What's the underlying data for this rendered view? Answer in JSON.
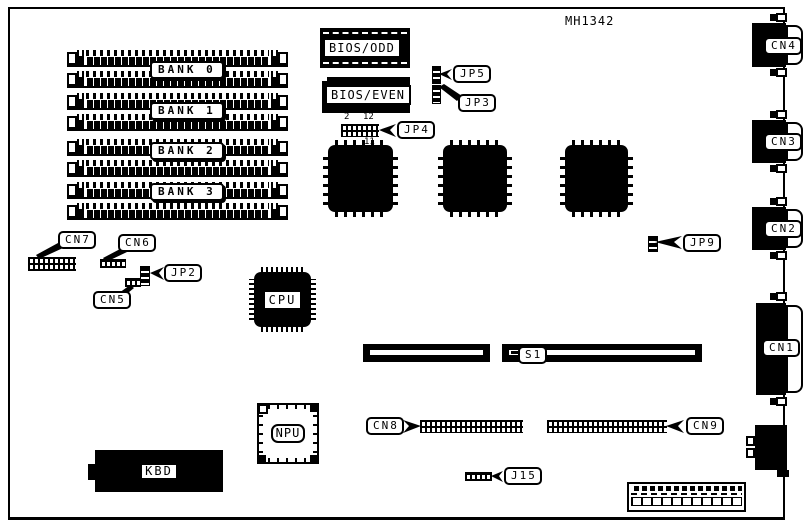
{
  "diagram": {
    "part_number": "MH1342",
    "banks": [
      {
        "label": "BANK 0"
      },
      {
        "label": "BANK 1"
      },
      {
        "label": "BANK 2"
      },
      {
        "label": "BANK 3"
      }
    ],
    "chips": {
      "bios_odd": "BIOS/ODD",
      "bios_even": "BIOS/EVEN",
      "cpu": "CPU",
      "npu": "NPU",
      "kbd": "KBD"
    },
    "jumpers": {
      "jp2": "JP2",
      "jp3": "JP3",
      "jp4": "JP4",
      "jp5": "JP5",
      "jp9": "JP9",
      "jp4_pin_top_left": "2",
      "jp4_pin_top_right": "12",
      "jp4_pin_bottom_right": "11"
    },
    "connectors": {
      "cn1": "CN1",
      "cn2": "CN2",
      "cn3": "CN3",
      "cn4": "CN4",
      "cn5": "CN5",
      "cn6": "CN6",
      "cn7": "CN7",
      "cn8": "CN8",
      "cn9": "CN9",
      "j15": "J15",
      "s1": "S1"
    },
    "colors": {
      "ink": "#000000",
      "paper": "#ffffff"
    }
  }
}
